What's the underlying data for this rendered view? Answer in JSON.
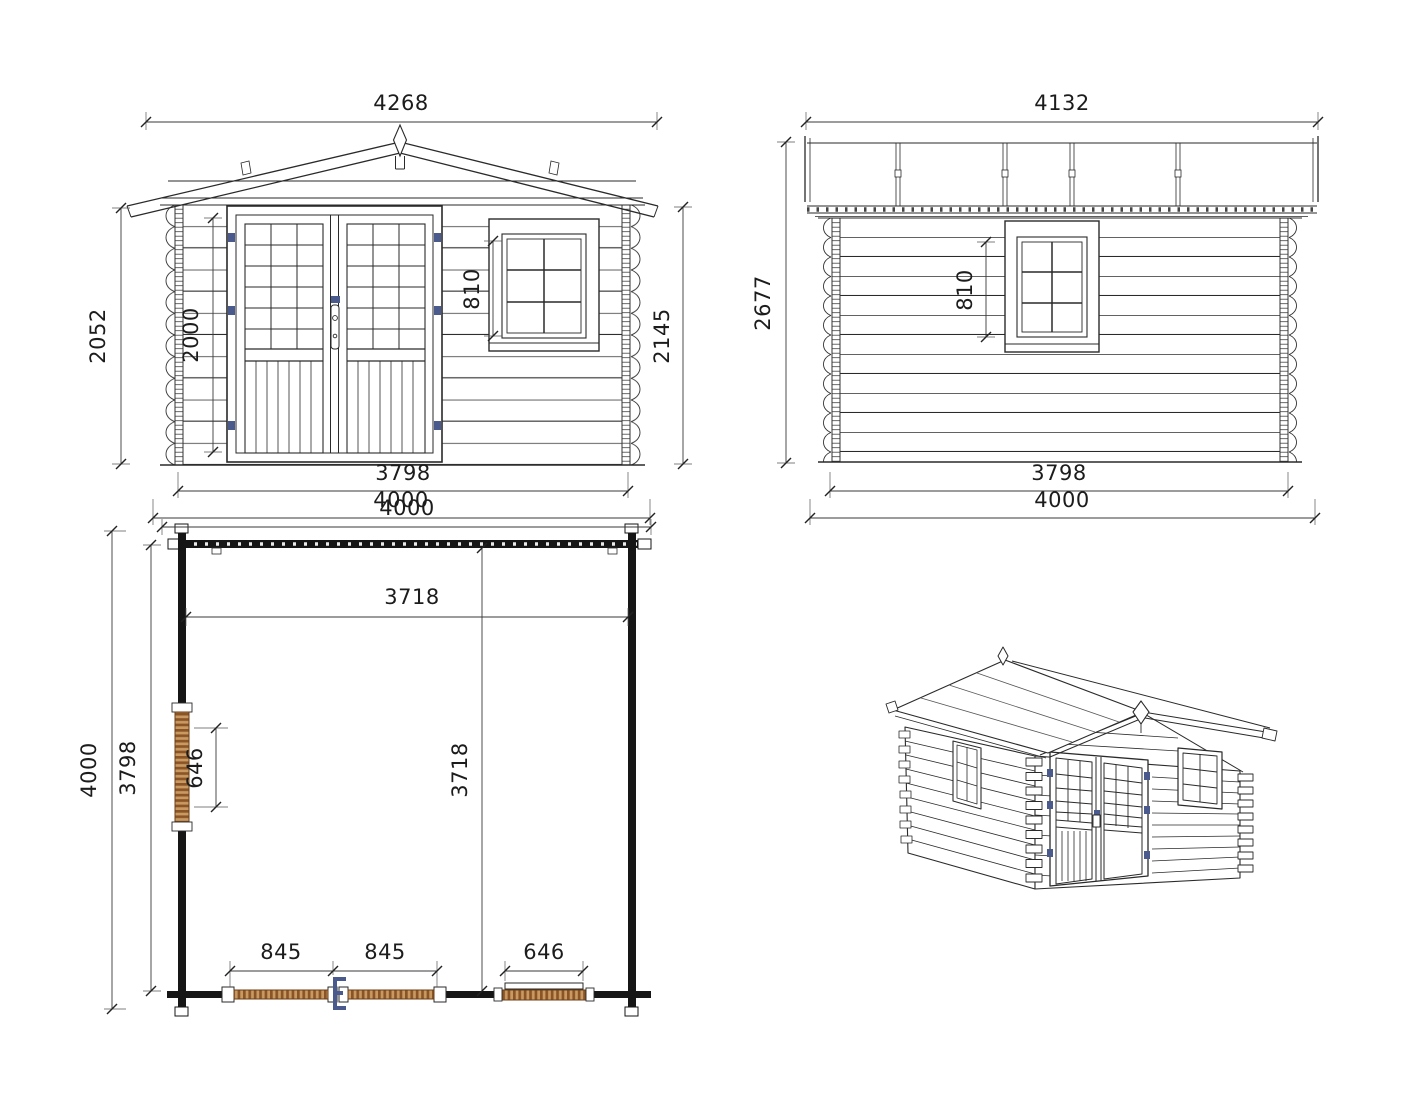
{
  "views": {
    "front_elevation": {
      "dims": {
        "roof_width": "4268",
        "wall_height": "2052",
        "door_height": "2000",
        "window_height": "810",
        "overall_height": "2145",
        "wall_width": "3798",
        "base_width": "4000"
      }
    },
    "side_elevation": {
      "dims": {
        "roof_length": "4132",
        "overall_height": "2677",
        "window_height": "810",
        "wall_length": "3798",
        "base_length": "4000"
      }
    },
    "floor_plan": {
      "dims": {
        "outer_width": "4000",
        "inner_width": "3718",
        "outer_depth": "4000",
        "wall_depth": "3798",
        "side_window_width": "646",
        "inner_depth": "3718",
        "door_leaf_left": "845",
        "door_leaf_right": "845",
        "front_window_width": "646"
      }
    }
  },
  "colors": {
    "line": "#2a2a2a",
    "hinge_blue": "#4a5a8c",
    "wood_light": "#c89a62",
    "wood_dark": "#8a5426",
    "plan_wall": "#161616"
  }
}
